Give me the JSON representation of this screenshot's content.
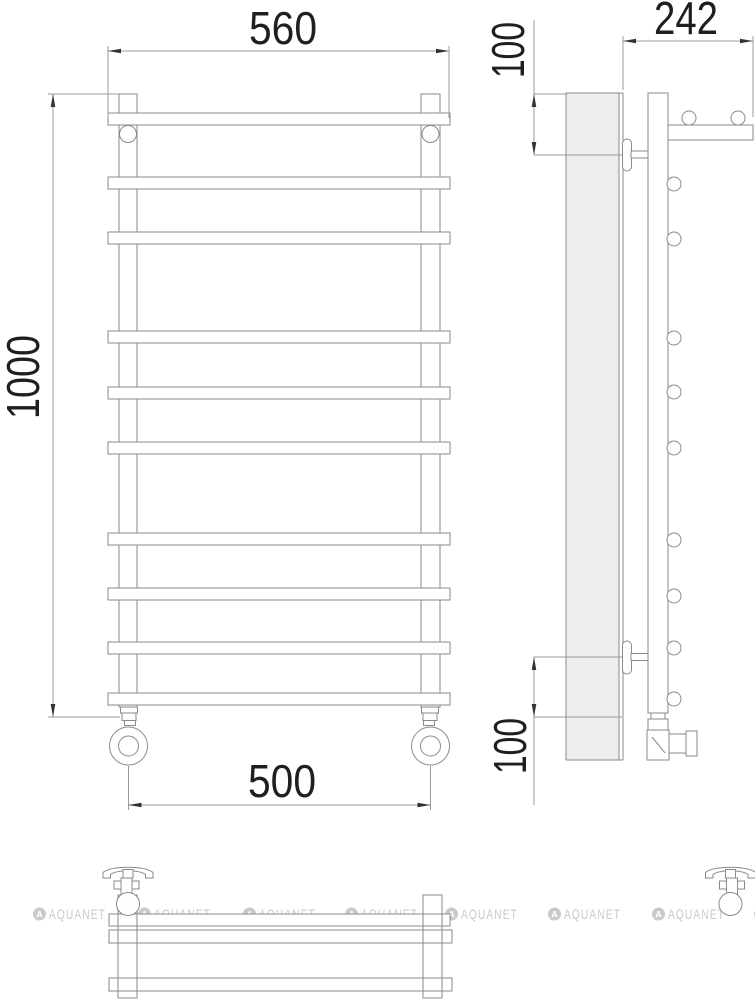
{
  "figure": {
    "type": "technical-drawing",
    "subject": "ladder towel rail with top shelf",
    "views": [
      "front",
      "side",
      "bottom"
    ],
    "rung_count": 10
  },
  "dimensions": {
    "front_overall_width": "560",
    "front_overall_height": "1000",
    "front_connection_spacing": "500",
    "side_depth": "242",
    "side_top_offset": "100",
    "side_bottom_offset": "100"
  },
  "watermark": {
    "brand": "AQUANET",
    "icon_letter": "A",
    "color": "#c9c9c9",
    "repeat_count": 8
  }
}
